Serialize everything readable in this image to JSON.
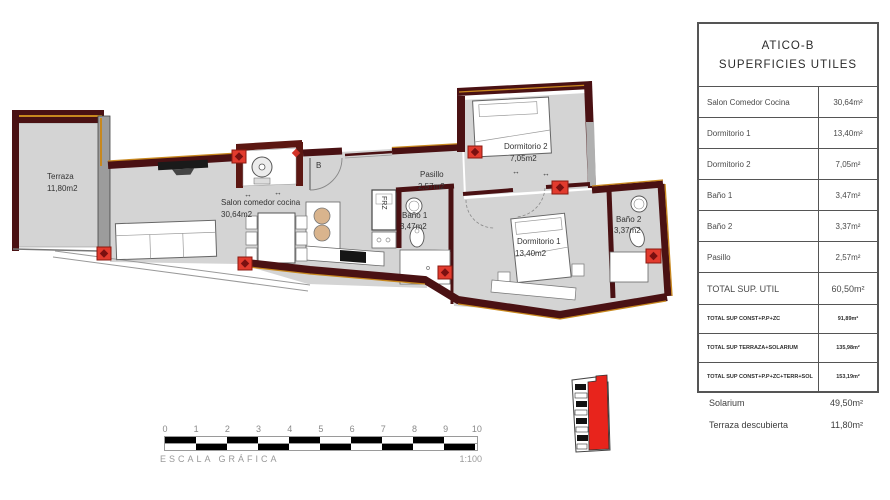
{
  "panel": {
    "title_line1": "ATICO-B",
    "title_line2": "SUPERFICIES UTILES",
    "rows": [
      {
        "label": "Salon Comedor Cocina",
        "value": "30,64m²"
      },
      {
        "label": "Dormitorio 1",
        "value": "13,40m²"
      },
      {
        "label": "Dormitorio 2",
        "value": "7,05m²"
      },
      {
        "label": "Baño 1",
        "value": "3,47m²"
      },
      {
        "label": "Baño 2",
        "value": "3,37m²"
      },
      {
        "label": "Pasillo",
        "value": "2,57m²"
      }
    ],
    "total_row": {
      "label": "TOTAL SUP. UTIL",
      "value": "60,50m²"
    },
    "small_rows": [
      {
        "label": "TOTAL SUP CONST+P.P+ZC",
        "value": "91,89m²"
      },
      {
        "label": "TOTAL SUP TERRAZA+SOLARIUM",
        "value": "135,98m²"
      },
      {
        "label": "TOTAL SUP CONST+P.P+ZC+TERR+SOL",
        "value": "153,19m²"
      }
    ],
    "extra_rows": [
      {
        "label": "Solarium",
        "value": "49,50m²"
      },
      {
        "label": "Terraza descubierta",
        "value": "11,80m²"
      }
    ]
  },
  "plan": {
    "rooms": {
      "terraza": {
        "name": "Terraza",
        "area": "11,80m2"
      },
      "salon": {
        "name": "Salon comedor cocina",
        "area": "30,64m2"
      },
      "pasillo": {
        "name": "Pasillo",
        "area": "2,57m2"
      },
      "dormitorio1": {
        "name": "Dormitorio 1",
        "area": "13,40m2"
      },
      "dormitorio2": {
        "name": "Dormitorio 2",
        "area": "7,05m2"
      },
      "bano1": {
        "name": "Baño 1",
        "area": "3,47m2"
      },
      "bano2": {
        "name": "Baño 2",
        "area": "3,37m2"
      }
    },
    "labels": {
      "door_b": "B",
      "fridge": "FRZ",
      "arrow": "↔"
    }
  },
  "scale_bar": {
    "ticks": [
      "0",
      "1",
      "2",
      "3",
      "4",
      "5",
      "6",
      "7",
      "8",
      "9",
      "10"
    ],
    "caption": "ESCALA GRÁFICA",
    "ratio": "1:100"
  },
  "colors": {
    "wall": "#4a1113",
    "hatch": "#c8881e",
    "floor": "#d4d4d4",
    "pillar": "#e23b2e",
    "unit_highlight": "#e8241c"
  }
}
